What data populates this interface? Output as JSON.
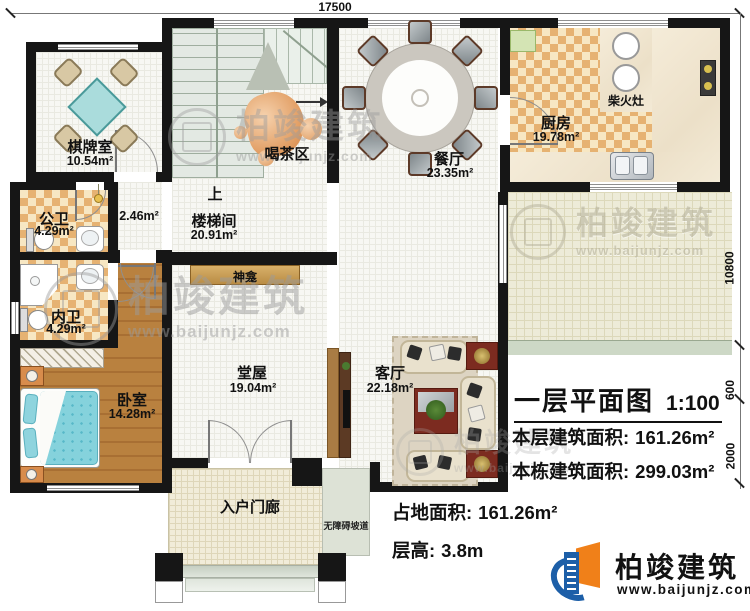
{
  "plan_title": {
    "title": "一层平面图",
    "scale": "1:100"
  },
  "stats": {
    "floor_area_label": "本层建筑面积:",
    "floor_area_value": "161.26m²",
    "building_area_label": "本栋建筑面积:",
    "building_area_value": "299.03m²",
    "site_area_label": "占地面积:",
    "site_area_value": "161.26m²",
    "height_label": "层高:",
    "height_value": "3.8m"
  },
  "rooms": {
    "chess": {
      "name": "棋牌室",
      "area": "10.54m²"
    },
    "public_wc": {
      "name": "公卫",
      "area": "4.29m²"
    },
    "private_wc": {
      "name": "内卫",
      "area": "4.29m²"
    },
    "bedroom": {
      "name": "卧室",
      "area": "14.28m²"
    },
    "stair": {
      "name": "楼梯间",
      "area": "20.91m²",
      "up": "上"
    },
    "hallway": {
      "area": "2.46m²"
    },
    "tea": {
      "name": "喝茶区"
    },
    "dining": {
      "name": "餐厅",
      "area": "23.35m²"
    },
    "kitchen": {
      "name": "厨房",
      "area": "19.78m²",
      "stove": "柴火灶"
    },
    "shrine": {
      "name": "神龛"
    },
    "main_hall": {
      "name": "堂屋",
      "area": "19.04m²"
    },
    "living": {
      "name": "客厅",
      "area": "22.18m²"
    },
    "porch": {
      "name": "入户门廊"
    },
    "ramp": {
      "name": "无障碍坡道"
    }
  },
  "dimensions": {
    "top_width": "17500",
    "right_upper": "10800",
    "right_mid": "600",
    "right_lower": "2000"
  },
  "brand": {
    "name": "柏竣建筑",
    "url": "www.baijunjz.com"
  },
  "colors": {
    "wall": "#161616",
    "tile": "#e6b272",
    "wood": "#b9813f",
    "teal_table": "#9fd8dc",
    "brand_blue": "#1d5fa8",
    "brand_orange": "#f08019",
    "accent_red": "#7c2b20"
  }
}
